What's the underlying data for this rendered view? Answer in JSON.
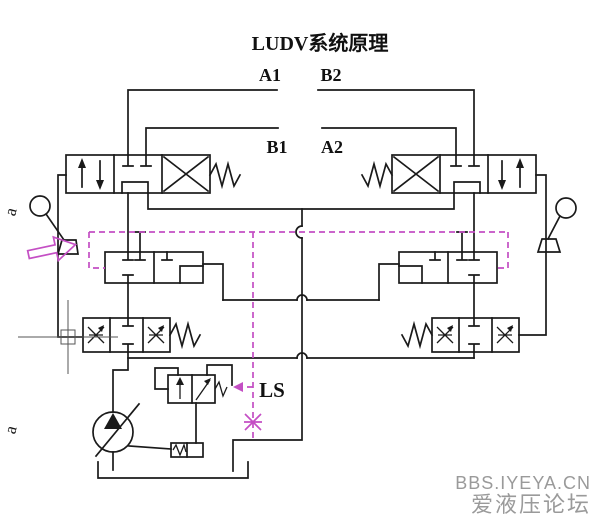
{
  "title": "LUDV系统原理",
  "ports": {
    "a1": "A1",
    "b2": "B2",
    "b1": "B1",
    "a2": "A2"
  },
  "ls_label": "LS",
  "lever_label_top": "a",
  "lever_label_bottom": "a",
  "watermark": {
    "line1": "BBS.IYEYA.CN",
    "line2": "爱液压论坛"
  },
  "colors": {
    "line": "#1a1a1a",
    "annotation": "#c44fc4",
    "watermark": "#9a9a9a",
    "crosshair": "#555555",
    "background": "#ffffff"
  }
}
